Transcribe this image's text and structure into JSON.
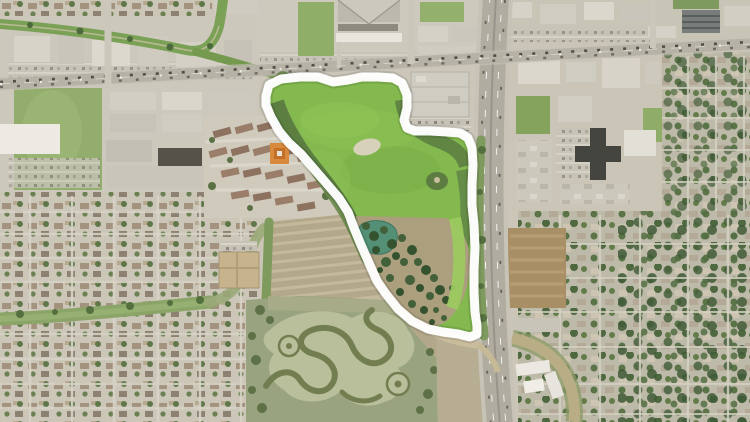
{
  "map": {
    "type": "satellite-aerial-photo",
    "description": "Aerial satellite view of a suburban area with a thick white boundary outline drawn around a green park parcel located southwest of a north-south highway and south of an east-west arterial road; surrounded by industrial buildings, residential neighborhoods, a plowed field and a wetland marsh",
    "annotation": {
      "label": "park boundary outline",
      "color": "#ffffff",
      "stroke_width": 9,
      "points": [
        [
          266,
          96
        ],
        [
          269,
          85
        ],
        [
          281,
          79
        ],
        [
          300,
          77
        ],
        [
          318,
          77
        ],
        [
          333,
          82
        ],
        [
          348,
          80
        ],
        [
          362,
          77
        ],
        [
          378,
          77
        ],
        [
          393,
          78
        ],
        [
          402,
          83
        ],
        [
          407,
          95
        ],
        [
          407,
          108
        ],
        [
          404,
          120
        ],
        [
          407,
          128
        ],
        [
          415,
          131
        ],
        [
          430,
          131
        ],
        [
          447,
          132
        ],
        [
          460,
          133
        ],
        [
          468,
          138
        ],
        [
          472,
          148
        ],
        [
          473,
          165
        ],
        [
          472,
          185
        ],
        [
          472,
          205
        ],
        [
          474,
          225
        ],
        [
          475,
          248
        ],
        [
          474,
          270
        ],
        [
          474,
          292
        ],
        [
          475,
          312
        ],
        [
          477,
          326
        ],
        [
          477,
          334
        ],
        [
          470,
          337
        ],
        [
          458,
          334
        ],
        [
          443,
          332
        ],
        [
          428,
          329
        ],
        [
          412,
          321
        ],
        [
          398,
          309
        ],
        [
          386,
          294
        ],
        [
          377,
          281
        ],
        [
          369,
          263
        ],
        [
          361,
          245
        ],
        [
          354,
          228
        ],
        [
          348,
          212
        ],
        [
          339,
          198
        ],
        [
          327,
          184
        ],
        [
          314,
          169
        ],
        [
          301,
          154
        ],
        [
          289,
          143
        ],
        [
          279,
          131
        ],
        [
          271,
          117
        ],
        [
          266,
          105
        ]
      ]
    },
    "palette": {
      "park_grass": "#83b94e",
      "woodland": "#42603a",
      "pond": "#549076",
      "marsh": "#9aa37f",
      "field": "#b3a88a",
      "urban": "#cbc6b8",
      "road": "#b6b2a6",
      "highway": "#b0aca0",
      "outline": "#ffffff"
    }
  }
}
